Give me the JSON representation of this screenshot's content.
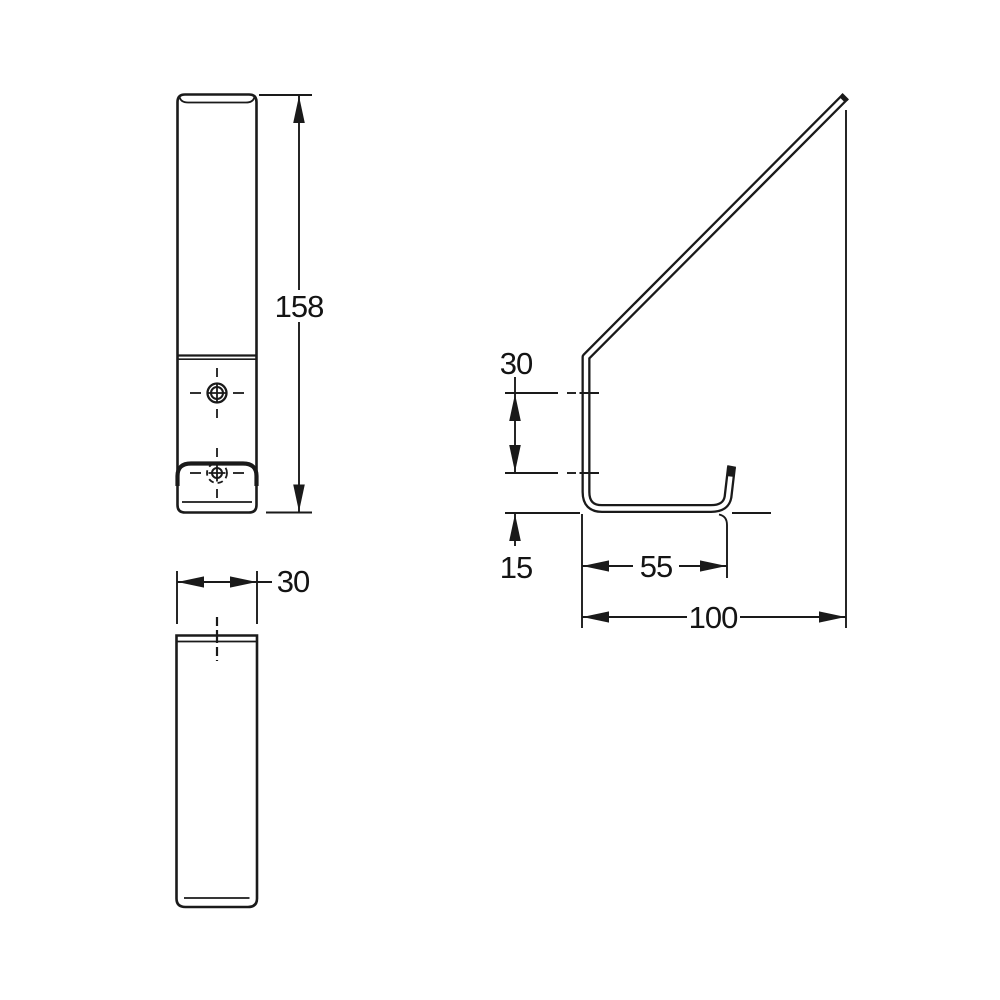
{
  "colors": {
    "background": "#ffffff",
    "line": "#1a1a1a"
  },
  "dimensions": {
    "overall_height": {
      "value": "158"
    },
    "overall_width": {
      "value": "30"
    },
    "hook_drop": {
      "value": "30"
    },
    "base_height": {
      "value": "15"
    },
    "inner_depth": {
      "value": "55"
    },
    "overall_depth": {
      "value": "100"
    }
  }
}
